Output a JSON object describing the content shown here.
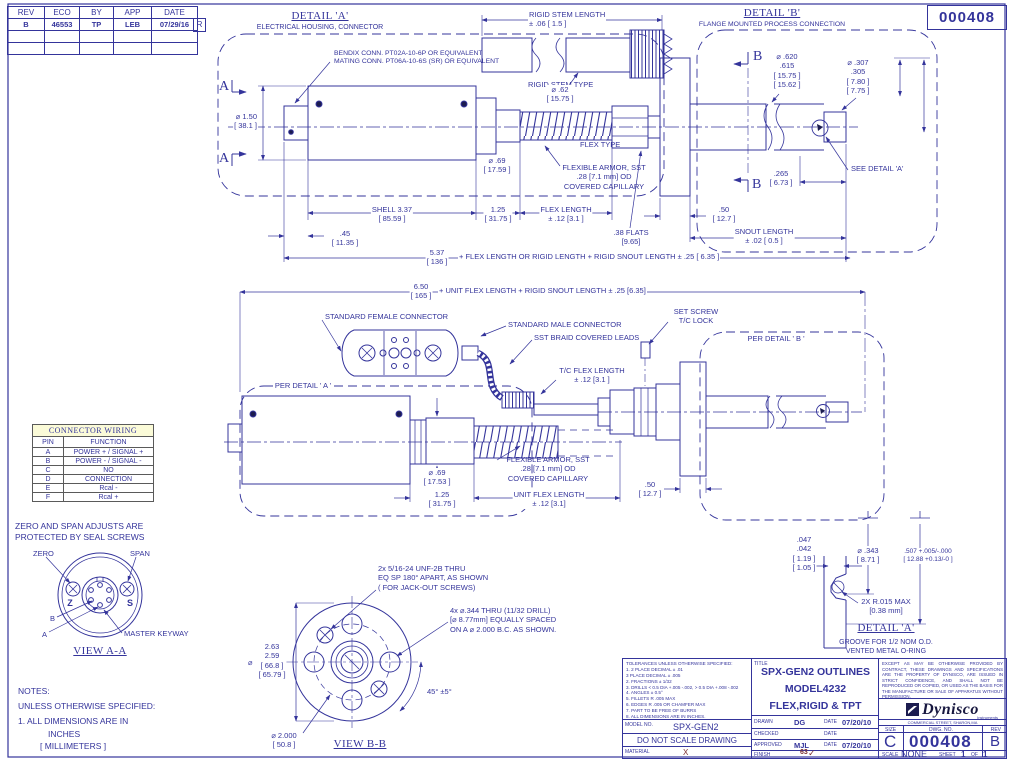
{
  "doc_no": "000408",
  "palette": {
    "ink": "#34349b",
    "table_header_bg": "#fbfbd8",
    "accent": "#7b3030"
  },
  "rev": {
    "h": [
      "REV",
      "ECO",
      "BY",
      "APP",
      "DATE"
    ],
    "r": [
      "B",
      "46553",
      "TP",
      "LEB",
      "07/29/16"
    ],
    "mark": "R"
  },
  "wiring": {
    "title": "CONNECTOR WIRING",
    "c1": "PIN",
    "c2": "FUNCTION",
    "rows": [
      [
        "A",
        "POWER + / SIGNAL +"
      ],
      [
        "B",
        "POWER - / SIGNAL -"
      ],
      [
        "C",
        "NO"
      ],
      [
        "D",
        "CONNECTION"
      ],
      [
        "E",
        "Rcal -"
      ],
      [
        "F",
        "Rcal +"
      ]
    ]
  },
  "ann": {
    "a1": "DETAIL 'A'",
    "a2": "ELECTRICAL HOUSING, CONNECTOR",
    "bendix": "BENDIX CONN. PT02A-10-6P OR EQUIVALENT\nMATING CONN. PT06A-10-6S (SR) OR EQUIVALENT",
    "rsl": "RIGID STEM LENGTH\n± .06 [ 1.5 ]",
    "rst": "RIGID STEM TYPE",
    "d62": "⌀  .62\n[ 15.75 ]",
    "b1": "DETAIL 'B'",
    "b2": "FLANGE MOUNTED PROCESS CONNECTION",
    "d620": "⌀ .620\n.615\n[ 15.75 ]\n[ 15.62 ]",
    "d307": "⌀ .307\n.305\n[ 7.80 ]\n[ 7.75 ]",
    "d150": "⌀  1.50\n[ 38.1 ]",
    "d69a": "⌀  .69\n[ 17.59 ]",
    "ftype": "FLEX TYPE",
    "farm": "FLEXIBLE ARMOR, SST\n.28 [7.1 mm] OD\nCOVERED CAPILLARY",
    "shell": "SHELL  3.37\n[ 85.59 ]",
    "l125": "1.25\n[ 31.75 ]",
    "flen": "FLEX LENGTH\n± .12 [3.1 ]",
    "l45": ".45\n[ 11.35 ]",
    "flats": ".38 FLATS\n[9.65]",
    "l50": ".50\n[ 12.7 ]",
    "snout": "SNOUT LENGTH\n± .02 [ 0.5 ]",
    "l537": "5.37\n[ 136 ]",
    "note1": "+ FLEX LENGTH OR RIGID LENGTH + RIGID SNOUT LENGTH  ± .25 [ 6.35 ]",
    "l265": ".265\n[ 6.73 ]",
    "seea": "SEE DETAIL 'A'",
    "l650": "6.50\n[ 165 ]",
    "note2": "+ UNIT FLEX LENGTH + RIGID SNOUT LENGTH  ± .25 [6.35]",
    "sfc": "STANDARD FEMALE CONNECTOR",
    "smc": "STANDARD MALE CONNECTOR",
    "braid": "SST BRAID COVERED LEADS",
    "setscrew": "SET SCREW\nT/C LOCK",
    "perb": "PER DETAIL ' B '",
    "tcflex": "T/C FLEX LENGTH\n± .12 [3.1 ]",
    "pera": "PER DETAIL ' A '",
    "d69b": "⌀  .69\n[ 17.53 ]",
    "uflen": "UNIT FLEX LENGTH\n± .12 [3.1]",
    "zspan": "ZERO AND SPAN ADJUSTS ARE\nPROTECTED BY SEAL SCREWS",
    "zero": "ZERO",
    "span": "SPAN",
    "zl": "Z",
    "sl": "S",
    "bp": "B",
    "ap": "A",
    "mkey": "MASTER KEYWAY",
    "vaa": "VIEW A-A",
    "n1": "NOTES:",
    "n2": "UNLESS OTHERWISE SPECIFIED:",
    "n3": "1. ALL DIMENSIONS ARE IN",
    "n4": "INCHES",
    "n5": "[ MILLIMETERS ]",
    "jack": "2x 5/16-24 UNF-2B THRU\nEQ SP 180° APART, AS SHOWN\n( FOR JACK-OUT SCREWS)",
    "holes4": "4x ⌀.344 THRU (11/32 DRILL)\n[⌀ 8.77mm] EQUALLY SPACED\nON A ⌀ 2.000 B.C. AS SHOWN.",
    "d263": "2.63\n2.59\n[ 66.8 ]\n[ 65.79 ]",
    "dia": "⌀",
    "a45": "45° ±5°",
    "d2000": "⌀  2.000\n[ 50.8 ]",
    "vbb": "VIEW B-B",
    "l047": ".047\n.042\n[ 1.19 ]\n[ 1.05 ]",
    "d343": "⌀  .343\n[ 8.71 ]",
    "l507": ".507 +.005/-.000\n[ 12.88 +0.13/-0 ]",
    "r015": "2X R.015 MAX\n[0.38 mm]",
    "da2": "DETAIL 'A'",
    "groove": "GROOVE FOR 1/2 NOM O.D.\nVENTED METAL O-RING",
    "secA": "A",
    "secB": "B"
  },
  "titleblock": {
    "tol": "TOLERANCES UNLESS OTHERWISE SPECIFIED:\n1. 2 PLACE DECIMAL ± .01\n    3 PLACE DECIMAL ± .005\n2. FRACTIONS ± 1/32\n3. DRILLS < 0.5 DIA +.005 -.002, > 0.5 DIA +.008 -.002\n4. ANGLES ± 0.5°\n5. FILLETS R .005 MAX\n6. EDGES R .005 OR CHAMFER MAX\n7. PART TO BE FREE OF BURRS\n8. ALL DIMENSIONS ARE IN INCHES.",
    "model_label": "MODEL NO.",
    "model": "SPX-GEN2",
    "dns": "DO NOT SCALE DRAWING",
    "material_label": "MATERIAL",
    "material": "X",
    "title_label": "TITLE",
    "title1": "SPX-GEN2 OUTLINES",
    "title2": "MODEL4232",
    "title3": "FLEX,RIGID & TPT",
    "drawn_label": "DRAWN",
    "drawn": "DG",
    "date_label": "DATE",
    "drawn_date": "07/20/10",
    "checked_label": "CHECKED",
    "checked": "",
    "checked_date": "",
    "approved_label": "APPROVED",
    "approved": "MJL",
    "approved_date": "07/20/10",
    "finish_label": "FINISH",
    "finish": "63",
    "finish_check": "✓",
    "legal": "EXCEPT AS MAY BE OTHERWISE PROVIDED BY CONTRACT, THESE DRAWINGS AND SPECIFICATIONS ARE THE PROPERTY OF DYNISCO, ARE ISSUED IN STRICT CONFIDENCE, AND SHALL NOT BE REPRODUCED OR COPIED, OR USED AS THE BASIS FOR THE MANUFACTURE OR SALE OF APPARATUS WITHOUT PERMISSION.",
    "brand": "Dynisco",
    "brand_sub": "Instruments",
    "address": "COMMERCIAL STREET, SHARON,MA",
    "size_label": "SIZE",
    "size": "C",
    "dwg_label": "DWG. NO.",
    "dwg": "000408",
    "rev_label": "REV",
    "rev": "B",
    "scale_label": "SCALE",
    "scale": "NONE",
    "sheet_label": "SHEET",
    "sheet": "1",
    "of_label": "OF",
    "total": "1"
  }
}
